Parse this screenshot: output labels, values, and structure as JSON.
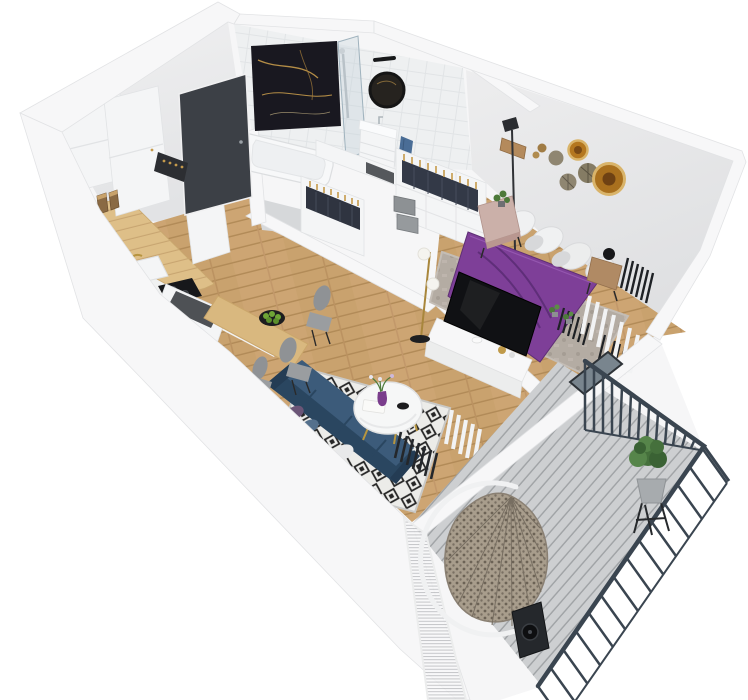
{
  "scene": {
    "alt": "3D isometric cutaway floor-plan render of a studio apartment with kitchen, hallway, bathroom, wardrobe area, bedroom with purple bed, living-dining area with navy sofa, and a balcony with a hanging egg chair",
    "type": "3d-floor-plan-render",
    "projection": "isometric cutaway viewed from above",
    "background": "#ffffff"
  },
  "palette": {
    "wall_white": "#f6f6f7",
    "wall_face_gray": "#e9eaeb",
    "floor_wood": "#c9a26e",
    "counter_wood": "#debf88",
    "door_charcoal": "#3c4046",
    "marble_black": "#191820",
    "marble_gold_vein": "#c59a4b",
    "bed_purple": "#7e3f98",
    "sofa_navy": "#31506e",
    "rug_white": "#ecece9",
    "rug_black": "#262626",
    "railing_slate": "#3a4550",
    "deck_gray": "#cdcfd1",
    "wicker_tan": "#a89d8c",
    "plant_green": "#4d7a3a",
    "brass_gold": "#b8963f",
    "towel_blue": "#4a6d96"
  },
  "rooms": {
    "kitchen": {
      "label": "Kitchen",
      "items": [
        "white wall cabinet",
        "tall white cabinet",
        "black coffee machine",
        "storage jars",
        "wooden countertop",
        "white sink",
        "brass faucet",
        "black cooktop",
        "white base cabinets",
        "kitchen island with dark top"
      ]
    },
    "hallway": {
      "label": "Hallway",
      "items": [
        "charcoal entrance door",
        "dark shoe rack",
        "oak plank floor"
      ]
    },
    "bathroom": {
      "label": "Bathroom",
      "items": [
        "black marble shower wall with gold veining",
        "glass shower screen",
        "chrome shower column",
        "white bathtub",
        "round black-framed mirror",
        "black wall sconce",
        "white vanity with sink",
        "blue towel",
        "white tile wall"
      ]
    },
    "wardrobe_area": {
      "label": "Wardrobe area",
      "items": [
        "two open wardrobe units",
        "dark clothes on brass hangers",
        "gray storage boxes",
        "white counter with dark tray"
      ]
    },
    "bedroom": {
      "label": "Bedroom",
      "items": [
        "double bed with purple duvet",
        "white and gray pillows",
        "blush nightstand with plant",
        "wooden nightstand with black ball lamp",
        "gray area rug",
        "round wood-slice wall decor",
        "tall black floor lamp",
        "wooden wall shelf",
        "black ladder racks",
        "white TV sideboard",
        "flat-screen TV",
        "brass floor lamp with glass globes",
        "white slat curtain",
        "glass balcony door"
      ]
    },
    "living_dining": {
      "label": "Living / dining area",
      "items": [
        "wooden dining table",
        "bowl of green apples",
        "three gray shell chairs",
        "navy blue sofa with cushions",
        "black-and-white diamond rug",
        "round white coffee table",
        "purple vase with flowers",
        "black bowl",
        "white tray",
        "black radiator grille",
        "white slat screen"
      ]
    },
    "balcony": {
      "label": "Balcony",
      "items": [
        "gray plank decking",
        "dark slate railing with vertical balusters",
        "rattan hanging egg chair with white stand",
        "potted plant on black stand",
        "black outdoor speaker",
        "white privacy mesh screen"
      ]
    }
  }
}
